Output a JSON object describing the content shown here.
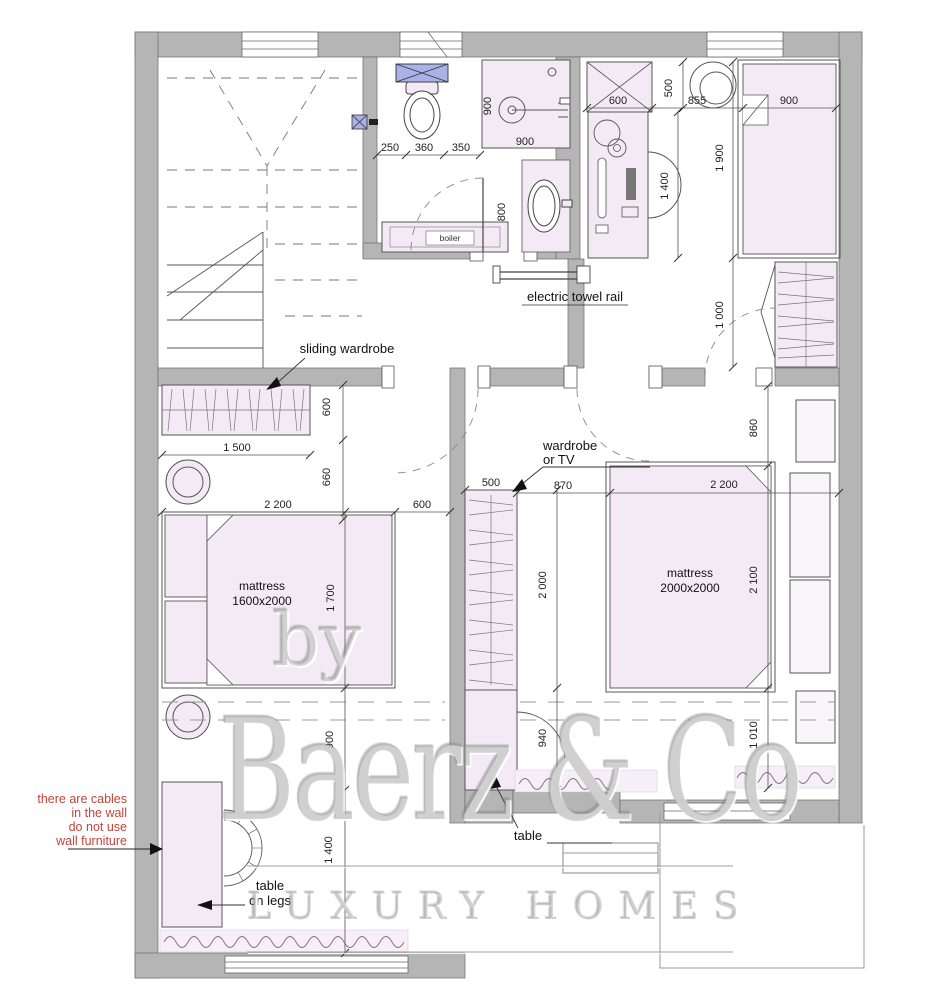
{
  "watermark": {
    "prefix": "by",
    "brand": "Baerz & Co",
    "tagline": "LUXURY HOMES"
  },
  "labels": {
    "electric_towel_rail": "electric towel rail",
    "sliding_wardrobe": "sliding wardrobe",
    "wardrobe_or_tv": [
      "wardrobe",
      "or TV"
    ],
    "mattress_left": [
      "mattress",
      "1600x2000"
    ],
    "mattress_right": [
      "mattress",
      "2000x2000"
    ],
    "boiler": "boiler",
    "table": "table",
    "table_on_legs": [
      "table",
      "on legs"
    ],
    "warning": [
      "there are cables",
      "in the wall",
      "do not use",
      "wall furniture"
    ]
  },
  "dimensions": {
    "bath": {
      "toilet_left": "250",
      "toilet": "360",
      "toilet_right": "350",
      "shower_w": "900",
      "shower_h": "900",
      "sink": "800"
    },
    "top_right": {
      "wardrobe": "600",
      "depth": "500",
      "pouf": "855",
      "bed_w": "900",
      "bed_l": "1 900",
      "desk": "1 400",
      "wardrobe2": "1 000"
    },
    "hall": {
      "wardrobe_w": "1 500",
      "wardrobe_d": "600",
      "gap": "660"
    },
    "left_bed": {
      "bed_w": "2 200",
      "gap": "600",
      "bed_l": "1 700",
      "below": "900",
      "room": "1 400"
    },
    "center": {
      "tv": "500",
      "gap": "870",
      "wardrobe_l": "2 000",
      "below": "940"
    },
    "right_bed": {
      "bed_w": "2 200",
      "bed_l": "2 100",
      "above": "860",
      "below": "1 010"
    }
  },
  "colors": {
    "wall": "#b5b5b5",
    "furniture_fill": "#f3eaf5",
    "accent_blue": "#a9b1e6",
    "dimension_text": "#222222",
    "warning_text": "#c4443a",
    "watermark": "#cccccc"
  }
}
